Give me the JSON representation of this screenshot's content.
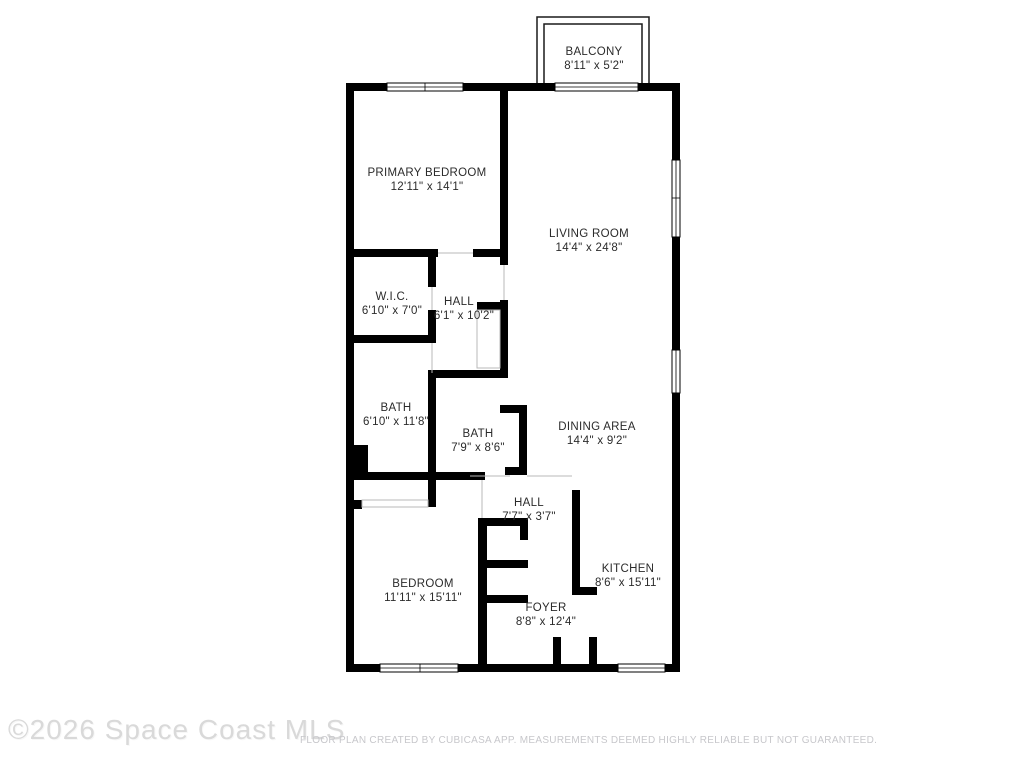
{
  "rooms": [
    {
      "id": "balcony",
      "name": "BALCONY",
      "dims": "8'11\" x 5'2\""
    },
    {
      "id": "primary-bedroom",
      "name": "PRIMARY BEDROOM",
      "dims": "12'11\" x 14'1\""
    },
    {
      "id": "living-room",
      "name": "LIVING ROOM",
      "dims": "14'4\" x 24'8\""
    },
    {
      "id": "wic",
      "name": "W.I.C.",
      "dims": "6'10\" x 7'0\""
    },
    {
      "id": "hall-upper",
      "name": "HALL",
      "dims": "6'1\" x 10'2\""
    },
    {
      "id": "bath-left",
      "name": "BATH",
      "dims": "6'10\" x 11'8\""
    },
    {
      "id": "bath-right",
      "name": "BATH",
      "dims": "7'9\" x 8'6\""
    },
    {
      "id": "dining-area",
      "name": "DINING AREA",
      "dims": "14'4\" x 9'2\""
    },
    {
      "id": "hall-lower",
      "name": "HALL",
      "dims": "7'7\" x 3'7\""
    },
    {
      "id": "kitchen",
      "name": "KITCHEN",
      "dims": "8'6\" x 15'11\""
    },
    {
      "id": "bedroom",
      "name": "BEDROOM",
      "dims": "11'11\" x 15'11\""
    },
    {
      "id": "foyer",
      "name": "FOYER",
      "dims": "8'8\" x 12'4\""
    }
  ],
  "footer": {
    "copyright": "©2026 Space Coast MLS",
    "disclaimer": "FLOOR PLAN CREATED BY CUBICASA APP. MEASUREMENTS DEEMED HIGHLY RELIABLE BUT NOT GUARANTEED."
  },
  "colors": {
    "wall": "#000000",
    "label_text": "#2b2b2b",
    "watermark": "#d9d9d9",
    "disclaimer_text": "#c7c7cb",
    "background": "#ffffff"
  }
}
